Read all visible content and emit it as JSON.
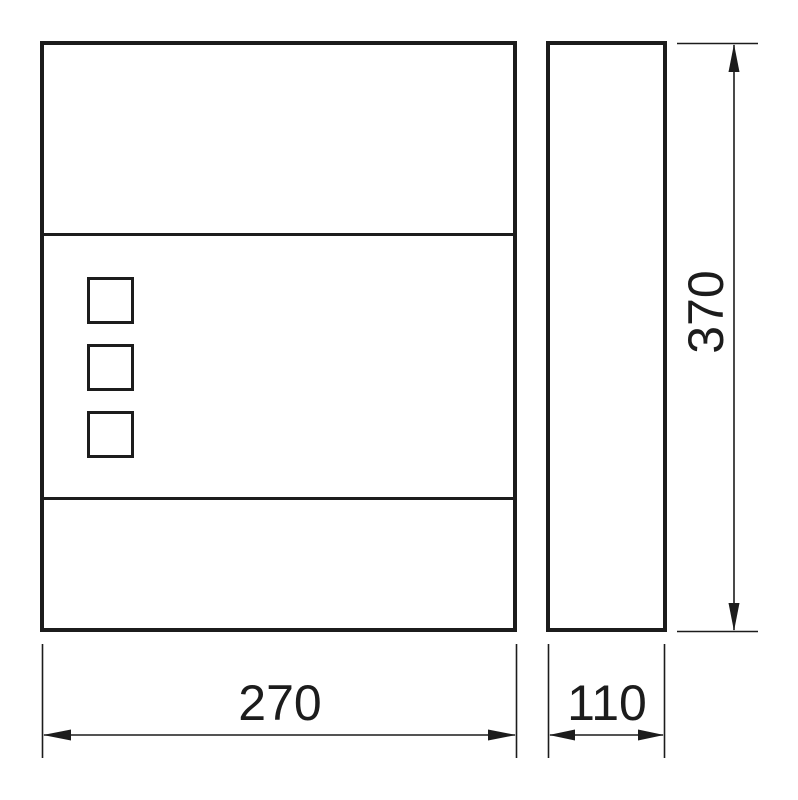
{
  "drawing": {
    "dimension_labels": {
      "width": "270",
      "depth": "110",
      "height": "370"
    },
    "front_view": {
      "window_slots": 3,
      "horizontal_dividers": 2
    },
    "side_view": {},
    "colors": {
      "line": "#1c1c1c",
      "background": "#ffffff"
    }
  }
}
